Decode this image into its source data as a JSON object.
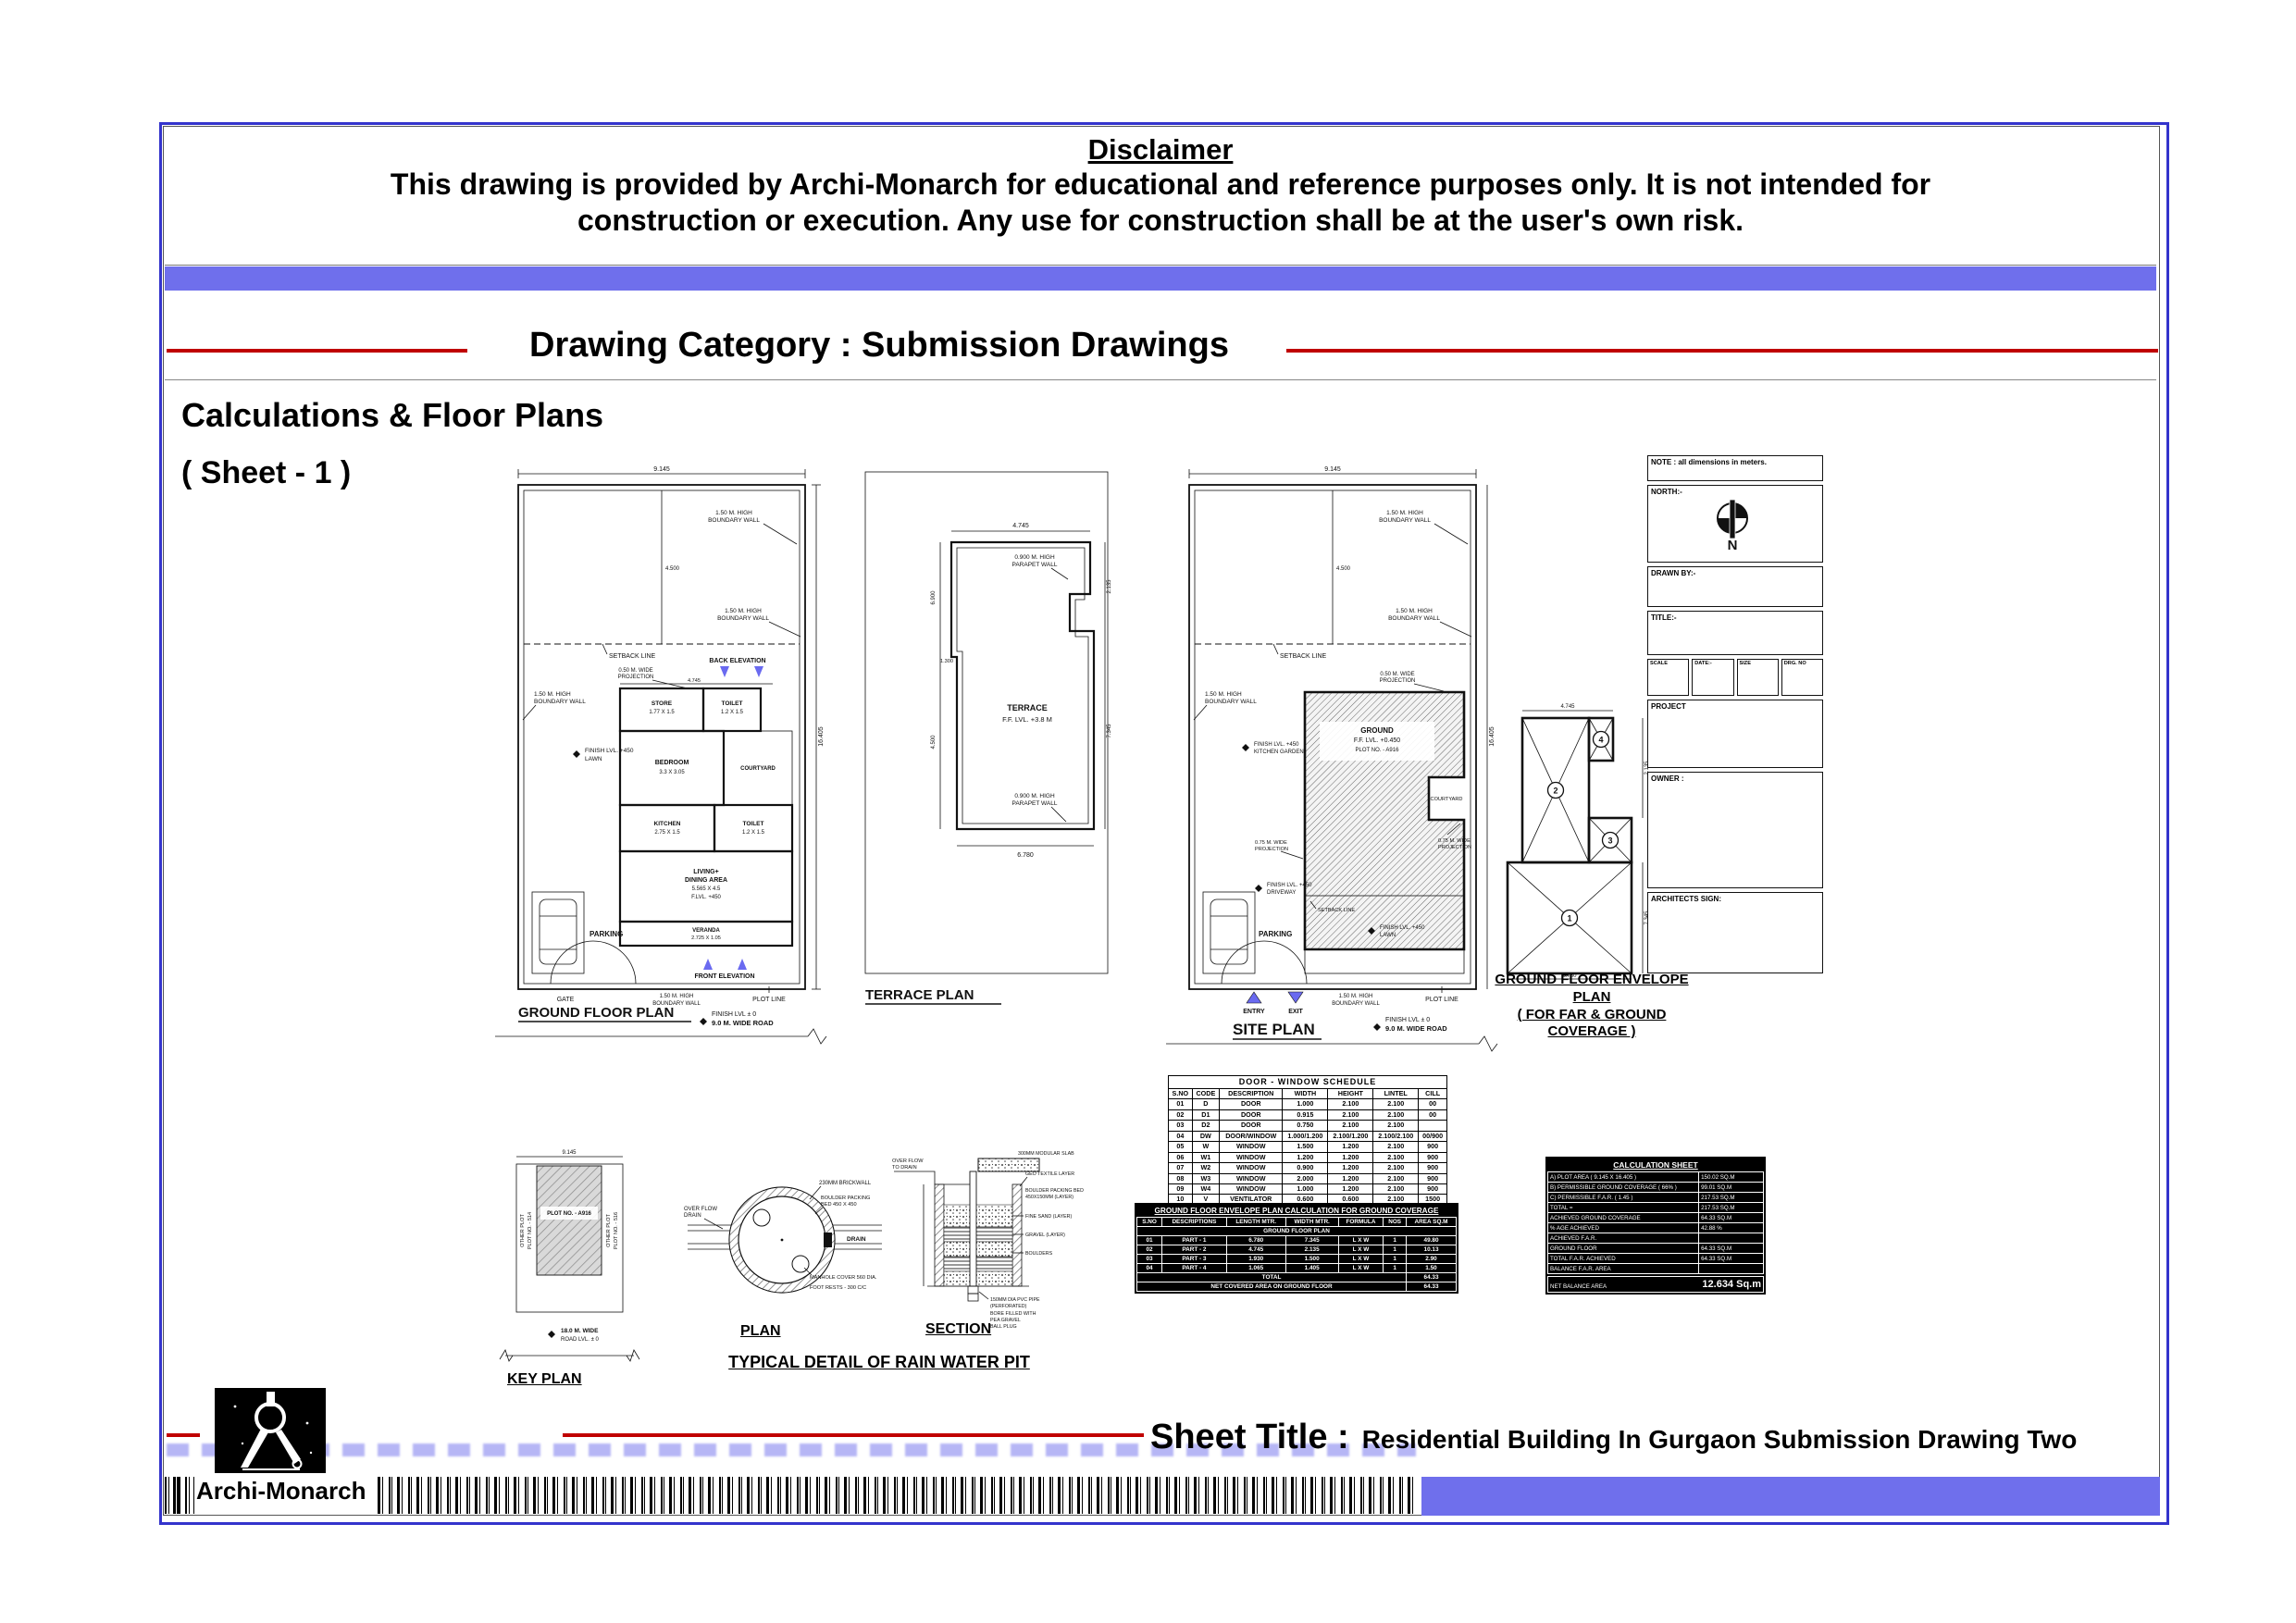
{
  "page": {
    "disclaimer_title": "Disclaimer",
    "disclaimer_line1": "This drawing is provided by Archi-Monarch for educational and reference purposes only. It is not intended for",
    "disclaimer_line2": "construction or execution. Any use for construction shall be at the user's own risk.",
    "category_heading": "Drawing Category : Submission Drawings",
    "section_title": "Calculations & Floor Plans",
    "sheet_no": "( Sheet - 1 )",
    "sheet_title_label": "Sheet Title :",
    "sheet_title": "Residential Building In Gurgaon Submission Drawing Two",
    "brand": "Archi-Monarch"
  },
  "colors": {
    "accent_blue": "#6f6fec",
    "border_blue": "#3434cc",
    "line_red": "#c00000",
    "marker_blue": "#6a6af0"
  },
  "common": {
    "bw1": "1.50 M. HIGH",
    "bw2": "BOUNDARY WALL",
    "pp1": "0.900 M. HIGH",
    "pp2": "PARAPET WALL",
    "pr50": "0.50 M. WIDE",
    "pr75": "0.75 M. WIDE",
    "prj": "PROJECTION",
    "setback": "SETBACK LINE",
    "plot_line": "PLOT LINE",
    "parking": "PARKING",
    "gate": "GATE",
    "fl450": "FINISH LVL. +450",
    "lawn": "LAWN",
    "driveway": "DRIVEWAY",
    "kgarden": "KITCHEN GARDEN",
    "road1": "FINISH LVL ± 0",
    "road2": "9.0 M. WIDE ROAD",
    "w": "9.145",
    "d": "16.405",
    "sb": "4.500",
    "bw": "4.745",
    "bw2d": "6.780",
    "t1": "2.135",
    "t2": "7.345",
    "t3": "6.900",
    "t4": "1.300"
  },
  "ground": {
    "title": "GROUND FLOOR PLAN",
    "back": "BACK ELEVATION",
    "front": "FRONT ELEVATION",
    "rooms": {
      "st1": "STORE",
      "st2": "1.77 X 1.5",
      "tl1": "TOILET",
      "tl2": "1.2 X 1.5",
      "bd1": "BEDROOM",
      "bd2": "3.3 X 3.05",
      "cy": "COURTYARD",
      "kt1": "KITCHEN",
      "kt2": "2.75 X 1.5",
      "lv1": "LIVING+",
      "lv2": "DINING AREA",
      "lv3": "5.565 X 4.5",
      "lv4": "F.LVL. +450",
      "vr1": "VERANDA",
      "vr2": "2.725 X 1.05"
    }
  },
  "terrace": {
    "title": "TERRACE PLAN",
    "name": "TERRACE",
    "lvl": "F.F. LVL. +3.8 M"
  },
  "site": {
    "title": "SITE PLAN",
    "g1": "GROUND",
    "g2": "F.F. LVL. +0.450",
    "g3": "PLOT NO. - A916",
    "cy": "COURTYARD",
    "entry": "ENTRY",
    "exit": "EXIT"
  },
  "envelope": {
    "t1": "GROUND FLOOR ENVELOPE PLAN",
    "t2": "( FOR FAR & GROUND COVERAGE )",
    "n1": "1",
    "n2": "2",
    "n3": "3",
    "n4": "4"
  },
  "title_block": {
    "note": "NOTE : all dimensions in meters.",
    "north": "NORTH:-",
    "n": "N",
    "drawn_by": "DRAWN BY:-",
    "title_label": "TITLE:-",
    "scale": "SCALE",
    "date": "DATE:-",
    "size": "SIZE",
    "drg_no": "DRG. NO",
    "project": "PROJECT",
    "owner": "OWNER :",
    "architect": "ARCHITECTS SIGN:"
  },
  "key_plan": {
    "title": "KEY PLAN",
    "plot": "PLOT NO. - A916",
    "op": "OTHER PLOT",
    "p514": "PLOT NO. - 514",
    "p516": "PLOT NO. - 516",
    "rd1": "18.0 M. WIDE",
    "rd2": "ROAD LVL. ± 0"
  },
  "rain_pit": {
    "plan": "PLAN",
    "section": "SECTION",
    "title": "TYPICAL DETAIL OF RAIN WATER PIT",
    "brick": "230MM BRICKWALL",
    "bb1": "BOULDER PACKING",
    "bb2": "BED 450 X 450",
    "of1": "OVER FLOW",
    "of2": "DRAIN",
    "drain": "DRAIN",
    "man": "MANHOLE COVER 560 DIA.",
    "foot": "FOOT RESTS - 300 C/C",
    "s0": "300MM MODULAR SLAB",
    "s1": "GEO TEXTILE LAYER",
    "s2": "BOULDER PACKING BED",
    "s3": "450X150MM (LAYER)",
    "s4": "FINE SAND (LAYER)",
    "s5": "GRAVEL (LAYER)",
    "s6": "BOULDERS",
    "b1": "150MM DIA PVC PIPE",
    "b2": "(PERFORATED)",
    "b3": "BORE FILLED WITH",
    "b4": "PEA GRAVEL",
    "b5": "BALL PLUG",
    "l1": "OVER FLOW",
    "l2": "TO DRAIN"
  },
  "schedule": {
    "title": "DOOR - WINDOW SCHEDULE",
    "headers": [
      "S.NO",
      "CODE",
      "DESCRIPTION",
      "WIDTH",
      "HEIGHT",
      "LINTEL",
      "CILL"
    ],
    "rows": [
      [
        "01",
        "D",
        "DOOR",
        "1.000",
        "2.100",
        "2.100",
        "00"
      ],
      [
        "02",
        "D1",
        "DOOR",
        "0.915",
        "2.100",
        "2.100",
        "00"
      ],
      [
        "03",
        "D2",
        "DOOR",
        "0.750",
        "2.100",
        "2.100",
        ""
      ],
      [
        "04",
        "DW",
        "DOOR/WINDOW",
        "1.000/1.200",
        "2.100/1.200",
        "2.100/2.100",
        "00/900"
      ],
      [
        "05",
        "W",
        "WINDOW",
        "1.500",
        "1.200",
        "2.100",
        "900"
      ],
      [
        "06",
        "W1",
        "WINDOW",
        "1.200",
        "1.200",
        "2.100",
        "900"
      ],
      [
        "07",
        "W2",
        "WINDOW",
        "0.900",
        "1.200",
        "2.100",
        "900"
      ],
      [
        "08",
        "W3",
        "WINDOW",
        "2.000",
        "1.200",
        "2.100",
        "900"
      ],
      [
        "09",
        "W4",
        "WINDOW",
        "1.000",
        "1.200",
        "2.100",
        "900"
      ],
      [
        "10",
        "V",
        "VENTILATOR",
        "0.600",
        "0.600",
        "2.100",
        "1500"
      ]
    ]
  },
  "coverage": {
    "title": "GROUND FLOOR ENVELOPE PLAN CALCULATION FOR GROUND COVERAGE",
    "headers": [
      "S.NO",
      "DESCRIPTIONS",
      "LENGTH MTR.",
      "WIDTH MTR.",
      "FORMULA",
      "NOS",
      "AREA SQ.M"
    ],
    "group": "GROUND FLOOR PLAN",
    "rows": [
      [
        "01",
        "PART - 1",
        "6.780",
        "7.345",
        "L X W",
        "1",
        "49.80"
      ],
      [
        "02",
        "PART - 2",
        "4.745",
        "2.135",
        "L X W",
        "1",
        "10.13"
      ],
      [
        "03",
        "PART - 3",
        "1.930",
        "1.500",
        "L X W",
        "1",
        "2.90"
      ],
      [
        "04",
        "PART - 4",
        "1.065",
        "1.405",
        "L X W",
        "1",
        "1.50"
      ]
    ],
    "total_label": "TOTAL",
    "total": "64.33",
    "net_label": "NET COVERED AREA ON GROUND FLOOR",
    "net": "64.33"
  },
  "calc": {
    "title": "CALCULATION SHEET",
    "rows": [
      [
        "A) PLOT AREA ( 9.145 X 16.405 )",
        "150.02 SQ.M"
      ],
      [
        "B) PERMISSIBLE GROUND COVERAGE ( 66% )",
        "99.01 SQ.M"
      ],
      [
        "C) PERMISSIBLE F.A.R. ( 1.45 )",
        "217.53 SQ.M"
      ],
      [
        "TOTAL =",
        "217.53 SQ.M"
      ],
      [
        "ACHIEVED GROUND COVERAGE",
        "64.33 SQ.M"
      ],
      [
        "% AGE ACHIEVED",
        "42.88 %"
      ],
      [
        "ACHIEVED F.A.R.",
        ""
      ],
      [
        "GROUND FLOOR",
        "64.33 SQ.M"
      ],
      [
        "TOTAL F.A.R. ACHIEVED",
        "64.33 SQ.M"
      ],
      [
        "BALANCE F.A.R. AREA",
        ""
      ]
    ],
    "final_label": "NET BALANCE AREA",
    "final": "12.634 Sq.m"
  }
}
